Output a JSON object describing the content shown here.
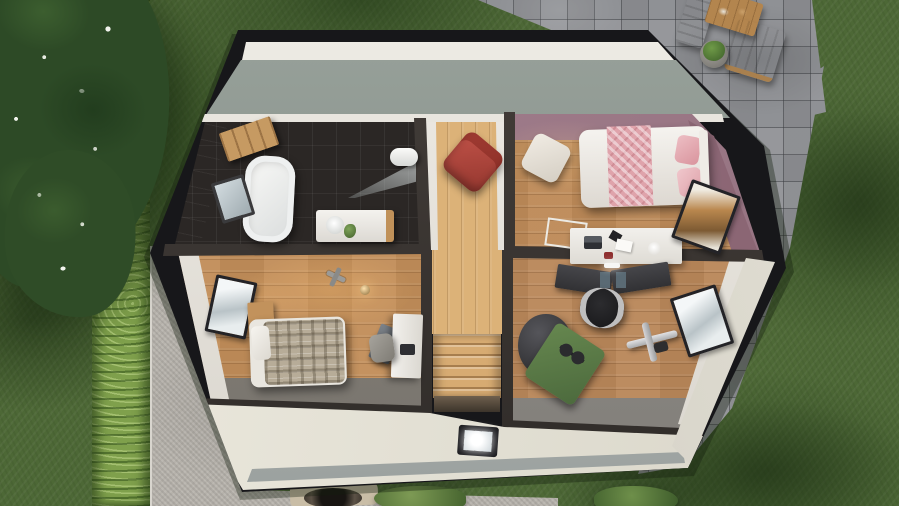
{
  "scene": {
    "type": "3d-architectural-render",
    "view": "top-down cutaway of upper floor with surrounding yard",
    "width_px": 899,
    "height_px": 506,
    "visible_text": ""
  },
  "palette": {
    "grass": "#4d6836",
    "grass_shadow": "#24401a",
    "hedge": "#7fa04c",
    "tree_canopy": "#2d4a26",
    "blossoms": "#eef1e8",
    "gravel": "#b6b2ab",
    "pavers": "#8f9195",
    "house_edge": "#17171a",
    "rear_roof_slope": "#8a948e",
    "front_roof_slope": "#e9e6db",
    "gutter": "#b4b8b6",
    "oak_floor_light": "#dcb278",
    "oak_floor_mid": "#c28e59",
    "bath_tile": "#2b2725",
    "mauve_wall": "#a17d8a",
    "red_armchair": "#b5463d",
    "pink_bedding": "#dfa3ab",
    "plaid_bedding": "#b7ac98",
    "green_mat": "#5d7d4c",
    "bean_bag": "#3d3d3f"
  },
  "environment": {
    "lawn": "grass with tree shadows",
    "hedge_row": "tall trimmed hedge, left side",
    "blossom_tree": "dark tree with white blossoms, top left",
    "gravel_driveway": "bottom left exterior strip",
    "stone_patio": {
      "location": "top right",
      "furniture": [
        "wooden dining table",
        "white bench",
        "white chair",
        "potted plant"
      ]
    },
    "stone_path": "paver path along right side of house",
    "fire_pit": "round grill on pad at bottom edge",
    "shrubs": 2
  },
  "house": {
    "floor_shown": "upper floor cutaway",
    "roof": [
      "rear roof slope (grey)",
      "front roof slope (cream) with skylight"
    ],
    "skylight_count": 1,
    "window_count": 4,
    "rooms": [
      {
        "name": "bathroom",
        "floor": "dark tile",
        "furniture": [
          "wall cabinet",
          "bathtub",
          "mirror",
          "shower screen",
          "vanity sink",
          "toilet",
          "plant"
        ]
      },
      {
        "name": "hallway-landing",
        "floor": "light oak",
        "furniture": [
          "red armchair",
          "staircase down",
          "skylight below stairwell"
        ]
      },
      {
        "name": "bedroom-pink",
        "walls": "mauve",
        "furniture": [
          "bed with pink and white bedding",
          "floor cushion",
          "white desk with laptop and papers",
          "trestle table",
          "window east"
        ]
      },
      {
        "name": "bedroom-plaid",
        "furniture": [
          "single bed with plaid duvet",
          "wooden nightstand",
          "floor lamp",
          "white desk",
          "grey chair",
          "leaning board",
          "toy helicopter",
          "window west"
        ]
      },
      {
        "name": "office-gym",
        "furniture": [
          "dark gaming desk with monitors",
          "gaming chair",
          "grey bean bag",
          "green exercise mat",
          "black dumbbell",
          "gym machine",
          "window east"
        ]
      }
    ]
  }
}
